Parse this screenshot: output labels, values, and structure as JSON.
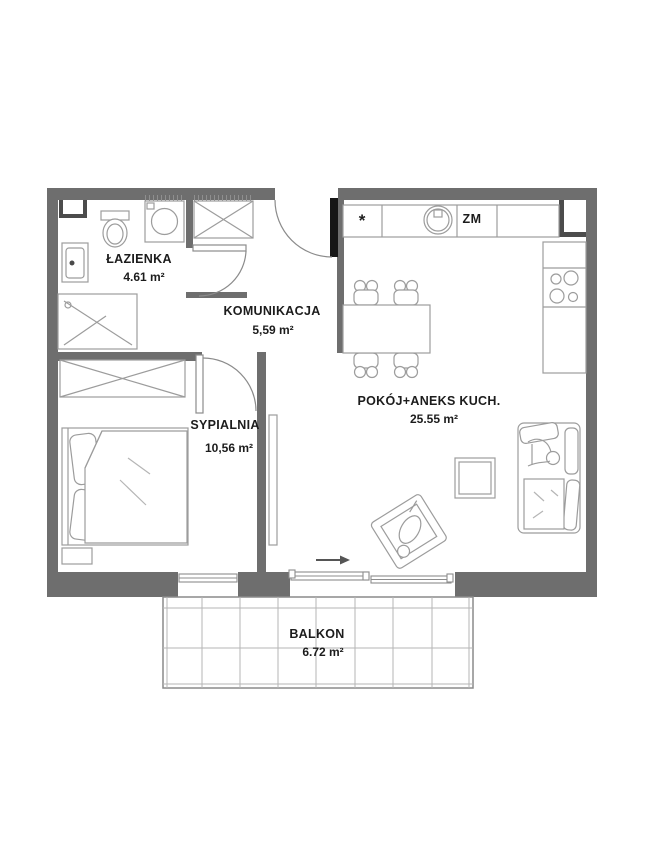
{
  "plan": {
    "rooms": {
      "lazienka": {
        "name": "ŁAZIENKA",
        "area": "4.61 m²"
      },
      "komunikacja": {
        "name": "KOMUNIKACJA",
        "area": "5,59 m²"
      },
      "sypialnia": {
        "name": "SYPIALNIA",
        "area": "10,56 m²"
      },
      "pokoj": {
        "name": "POKÓJ+ANEKS KUCH.",
        "area": "25.55 m²"
      },
      "balkon": {
        "name": "BALKON",
        "area": "6.72 m²"
      }
    },
    "kitchen": {
      "dishwasher_label": "ZM",
      "fridge_star": "*"
    },
    "colors": {
      "wall": "#6e6e6e",
      "furniture_line": "#9c9c9c",
      "entrance_door": "#161616",
      "text": "#1c1c1c"
    }
  }
}
